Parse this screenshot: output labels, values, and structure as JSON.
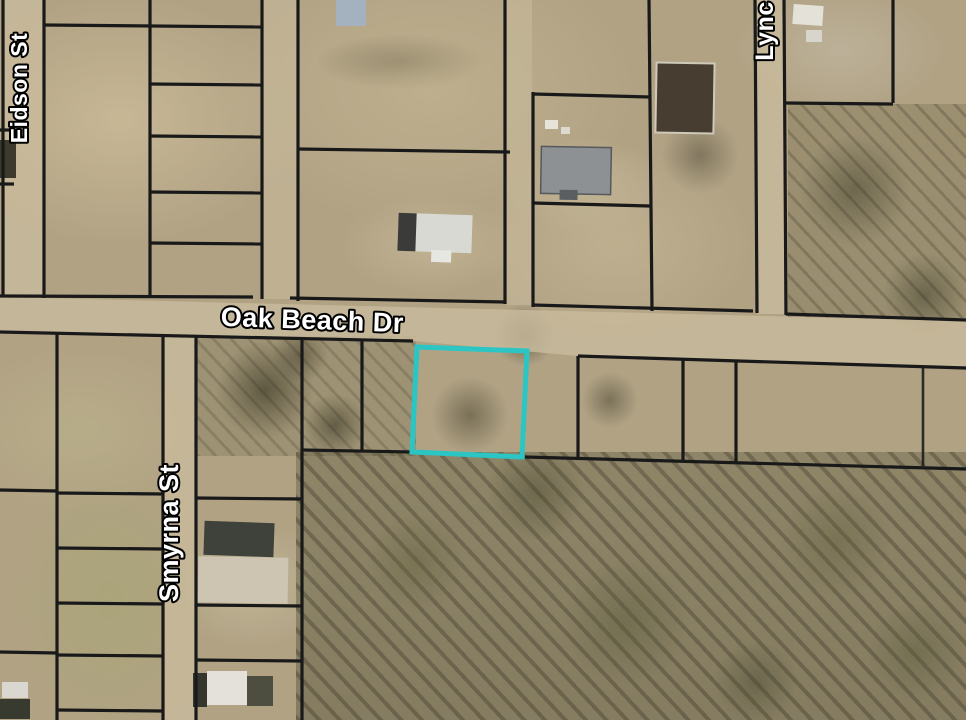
{
  "map": {
    "title": "Aerial parcel map with highlighted vacant lot on Oak Beach Dr",
    "highlight": {
      "color": "#2bc6c4"
    },
    "boundary_color": "#191919",
    "label_fill": "#ffffff",
    "label_outline": "#000000",
    "streets": [
      {
        "id": "eidson",
        "label": "Eidson St"
      },
      {
        "id": "oak-beach",
        "label": "Oak Beach Dr"
      },
      {
        "id": "smyrna",
        "label": "Smyrna St"
      },
      {
        "id": "lync",
        "label": "Lync"
      }
    ]
  }
}
